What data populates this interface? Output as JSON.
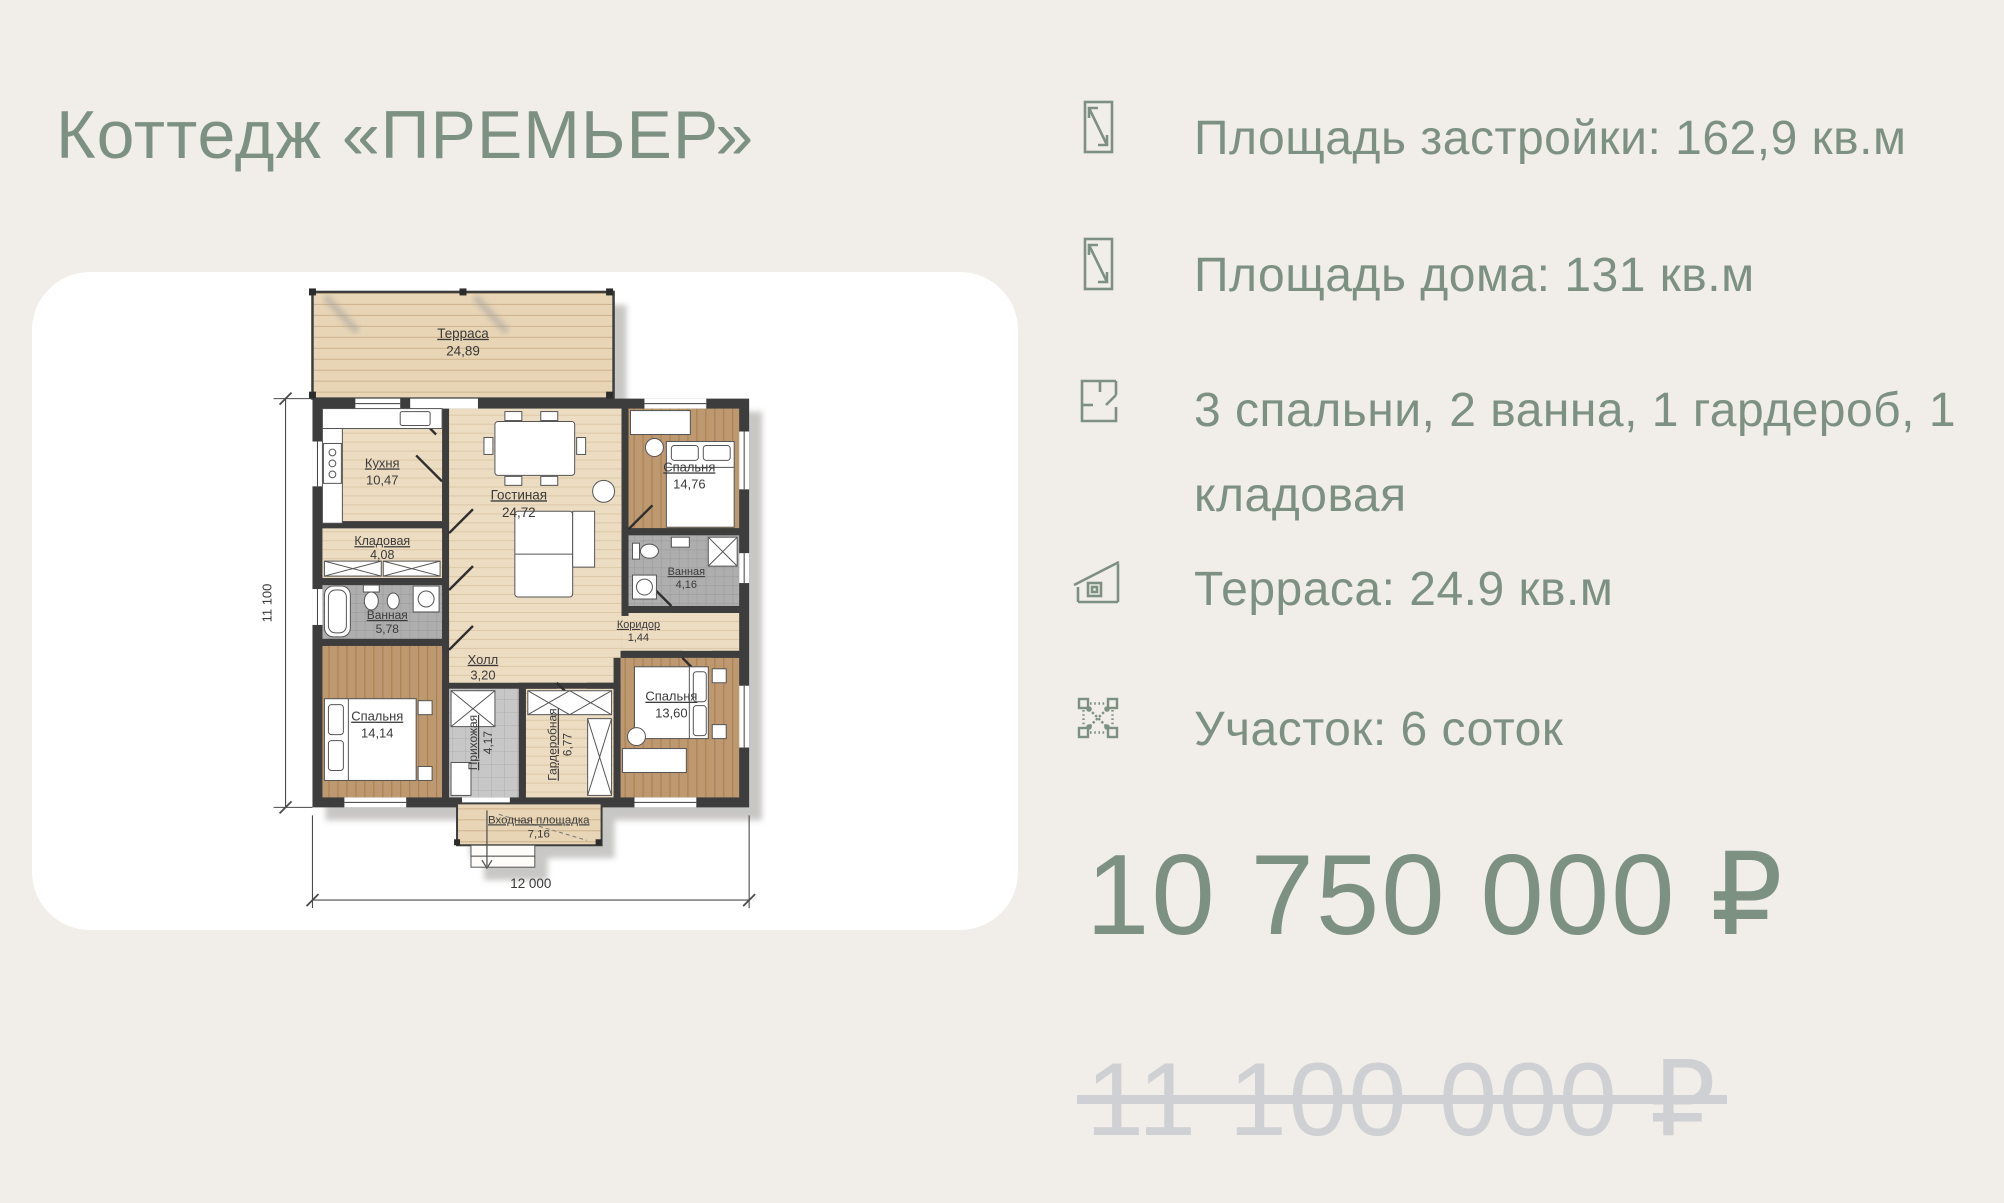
{
  "title": "Коттедж «ПРЕМЬЕР»",
  "specs": [
    {
      "icon": "diagonal-area-icon",
      "label": "Площадь застройки: 162,9 кв.м"
    },
    {
      "icon": "diagonal-area-icon",
      "label": "Площадь дома: 131 кв.м"
    },
    {
      "icon": "floorplan-icon",
      "label": "3 спальни, 2 ванна, 1 гардероб, 1 кладовая"
    },
    {
      "icon": "house-icon",
      "label": "Терраса: 24.9 кв.м"
    },
    {
      "icon": "land-plot-icon",
      "label": "Участок: 6 соток"
    }
  ],
  "price": {
    "current": "10 750 000 ₽",
    "old": "11 100 000 ₽"
  },
  "floorplan": {
    "dim_height": "11 100",
    "dim_width": "12 000",
    "rooms": [
      {
        "name": "Терраса",
        "area": "24,89"
      },
      {
        "name": "Кухня",
        "area": "10,47"
      },
      {
        "name": "Кладовая",
        "area": "4,08"
      },
      {
        "name": "Ванная",
        "area": "5,78"
      },
      {
        "name": "Спальня",
        "area": "14,14"
      },
      {
        "name": "Гостиная",
        "area": "24,72"
      },
      {
        "name": "Холл",
        "area": "3,20"
      },
      {
        "name": "Прихожая",
        "area": "4,17"
      },
      {
        "name": "Гардеробная",
        "area": "6,77"
      },
      {
        "name": "Коридор",
        "area": "1,44"
      },
      {
        "name": "Ванная",
        "area": "4,16"
      },
      {
        "name": "Спальня",
        "area": "14,76"
      },
      {
        "name": "Спальня",
        "area": "13,60"
      },
      {
        "name": "Входная площадка",
        "area": "7,16"
      }
    ]
  },
  "colors": {
    "accent": "#7d9183",
    "background": "#f1ede8",
    "card": "#ffffff",
    "wall": "#3e3d3d",
    "old_price": "#ced0d3"
  }
}
